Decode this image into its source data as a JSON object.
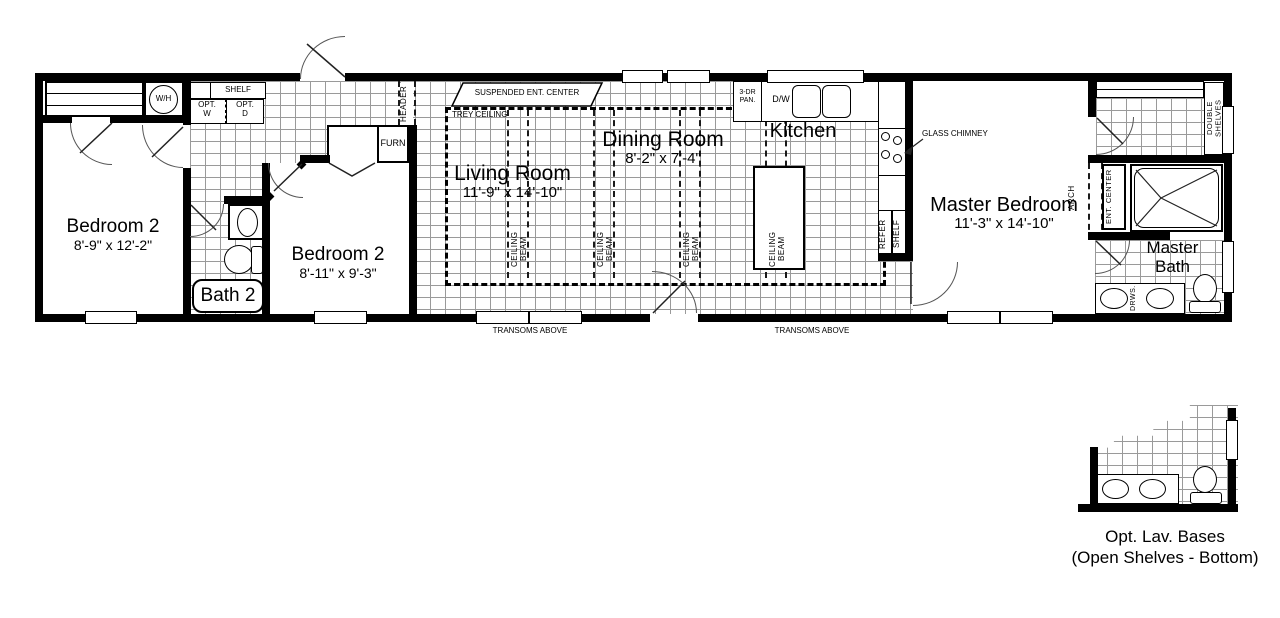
{
  "palette": {
    "wall": "#000000",
    "tile_line": "#9a9a9a",
    "background": "#ffffff"
  },
  "rooms": {
    "bedroom2_left": {
      "name": "Bedroom 2",
      "dims": "8'-9\" x 12'-2\""
    },
    "bedroom2_mid": {
      "name": "Bedroom 2",
      "dims": "8'-11\" x 9'-3\""
    },
    "bath2": {
      "name": "Bath 2"
    },
    "living_room": {
      "name": "Living Room",
      "dims": "11'-9\" x 14'-10\""
    },
    "dining_room": {
      "name": "Dining Room",
      "dims": "8'-2\" x 7'-4\""
    },
    "kitchen": {
      "name": "Kitchen"
    },
    "master_bedroom": {
      "name": "Master Bedroom",
      "dims": "11'-3\" x 14'-10\""
    },
    "master_bath": {
      "name": "Master\nBath"
    }
  },
  "fixtures": {
    "water_heater": "W/H",
    "shelf": "SHELF",
    "opt_washer": "OPT.\nW",
    "opt_dryer": "OPT.\nD",
    "furnace": "FURN",
    "header": "HEADER",
    "suspended_ent_center": "SUSPENDED ENT. CENTER",
    "trey_ceiling": "TREY CEILING",
    "ceiling_beam": "CEILING BEAM",
    "pantry": "3-DR\nPAN.",
    "dishwasher": "D/W",
    "glass_chimney": "GLASS CHIMNEY",
    "refrigerator": "REFER",
    "transoms": "TRANSOMS ABOVE",
    "arch": "ARCH",
    "ent_center": "ENT. CENTER",
    "double_shelves": "DOUBLE SHELVES",
    "drawers": "DRWS."
  },
  "inset": {
    "caption_line1": "Opt. Lav. Bases",
    "caption_line2": "(Open Shelves - Bottom)"
  }
}
